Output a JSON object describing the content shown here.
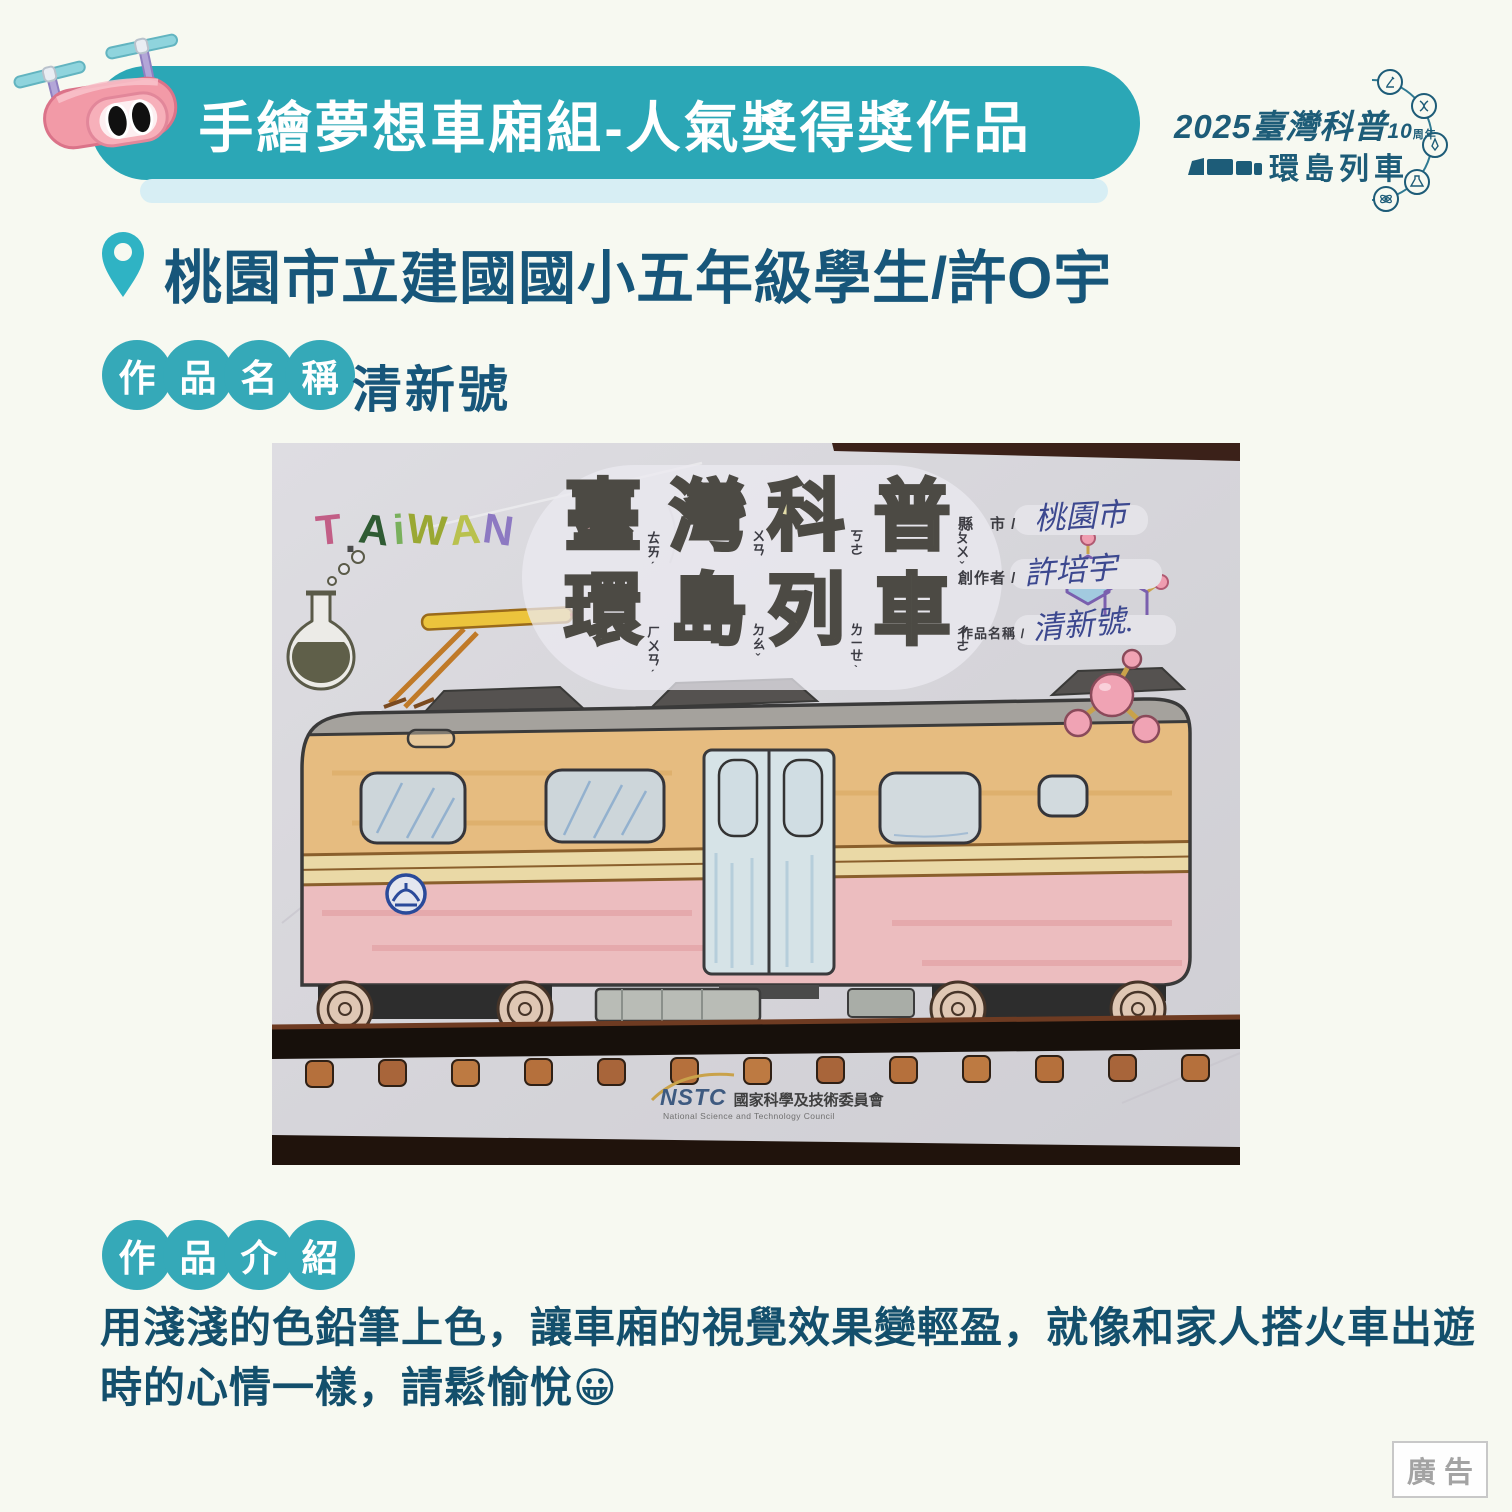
{
  "colors": {
    "page_bg": "#f7f9f1",
    "banner_teal": "#2ba7b6",
    "banner_strip": "#d7eef4",
    "badge_teal": "#35a9b8",
    "heading_text": "#17567a",
    "logo_teal": "#1d5c78",
    "ad_gray": "#a3a3a3"
  },
  "header": {
    "title": "手繪夢想車廂組-人氣獎得獎作品",
    "logo": {
      "year": "2025",
      "brand": "臺灣科普",
      "anniversary_number": "10",
      "anniversary_unit": "周年",
      "line2": "環島列車",
      "orbit_icons": [
        "microscope",
        "dna",
        "rocket",
        "flask",
        "atom"
      ]
    }
  },
  "location": {
    "text": "桃園市立建國國小五年級學生/許O宇"
  },
  "work_name": {
    "badge": [
      "作",
      "品",
      "名",
      "稱"
    ],
    "value": "清新號"
  },
  "photo": {
    "taiwan_letters": [
      "T",
      ".",
      "A",
      "i",
      "W",
      "A",
      "N"
    ],
    "bubble_title": {
      "row1": [
        "臺",
        "灣",
        "科",
        "普"
      ],
      "row1_zhuyin": [
        "ㄊㄞˊ",
        "ㄨㄢ",
        "ㄎㄜ",
        "ㄆㄨˇ"
      ],
      "row2": [
        "環",
        "島",
        "列",
        "車"
      ],
      "row2_zhuyin": [
        "ㄏㄨㄢˊ",
        "ㄉㄠˇ",
        "ㄌㄧㄝˋ",
        "ㄔㄜ"
      ]
    },
    "form": {
      "county_label": "縣　市 /",
      "county_value": "桃園市",
      "creator_label": "創作者 /",
      "creator_value": "許培宇",
      "title_label": "作品名稱 /",
      "title_value": "清新號."
    },
    "nstc": {
      "abbr": "NSTC",
      "zh": "國家科學及技術委員會",
      "en": "National Science and Technology Council"
    }
  },
  "intro": {
    "badge": [
      "作",
      "品",
      "介",
      "紹"
    ],
    "text": "用淺淺的色鉛筆上色，讓車廂的視覺效果變輕盈，就像和家人搭火車出遊時的心情一樣，請鬆愉悅",
    "emoji": "😀"
  },
  "ad_label": "廣告"
}
